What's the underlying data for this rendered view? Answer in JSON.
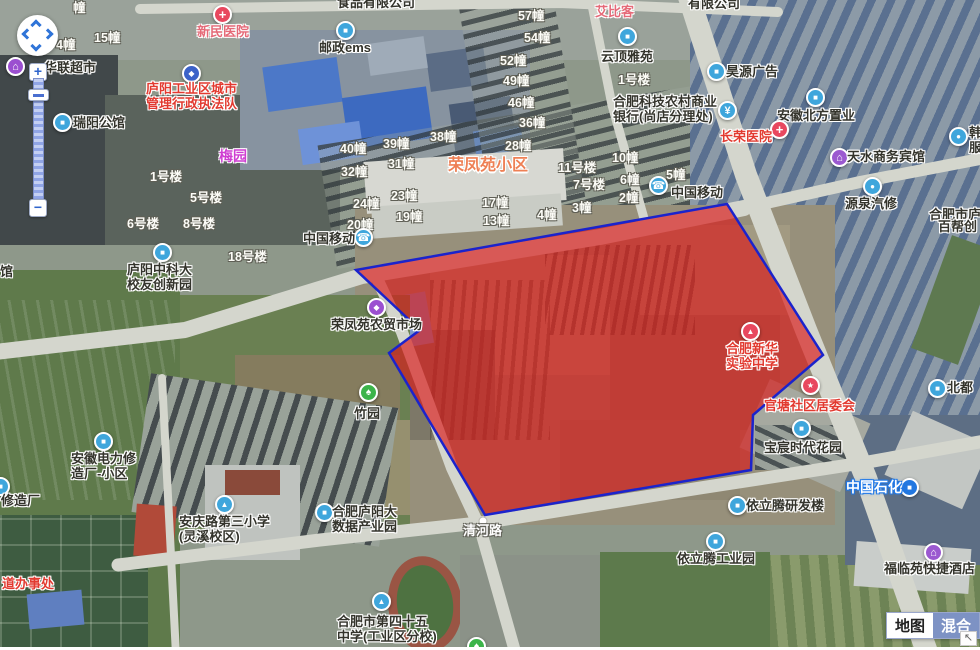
{
  "controls": {
    "zoom_in": "+",
    "zoom_out": "−",
    "corner_arrow": "↖",
    "map_type": [
      {
        "label": "地图",
        "active": false
      },
      {
        "label": "混合",
        "active": true
      }
    ]
  },
  "road_label": {
    "text": "清河路",
    "x": 463,
    "y": 524,
    "dot_x": 483,
    "dot_y": 521
  },
  "polygon": {
    "points": [
      [
        356,
        270
      ],
      [
        727,
        204
      ],
      [
        823,
        355
      ],
      [
        753,
        415
      ],
      [
        751,
        470
      ],
      [
        485,
        515
      ],
      [
        389,
        353
      ],
      [
        420,
        330
      ]
    ],
    "fill": "rgba(219,24,24,0.66)",
    "stroke": "#1b23cc",
    "stroke_width": 2.5
  },
  "area_labels": [
    {
      "t": "荣凤苑小区",
      "x": 448,
      "y": 157,
      "style": "orange",
      "size": 16
    },
    {
      "t": "艾比客",
      "x": 595,
      "y": 5,
      "style": "pink",
      "size": 13
    },
    {
      "t": "梅园",
      "x": 219,
      "y": 149,
      "style": "magenta",
      "size": 14
    }
  ],
  "building_labels": [
    {
      "t": "幢",
      "x": 73,
      "y": -3
    },
    {
      "t": "15幢",
      "x": 94,
      "y": 27
    },
    {
      "t": "4幢",
      "x": 56,
      "y": 34
    },
    {
      "t": "1号楼",
      "x": 150,
      "y": 166
    },
    {
      "t": "5号楼",
      "x": 190,
      "y": 187
    },
    {
      "t": "6号楼",
      "x": 127,
      "y": 213
    },
    {
      "t": "8号楼",
      "x": 183,
      "y": 213
    },
    {
      "t": "18号楼",
      "x": 228,
      "y": 246
    },
    {
      "t": "40幢",
      "x": 340,
      "y": 138
    },
    {
      "t": "39幢",
      "x": 383,
      "y": 133
    },
    {
      "t": "38幢",
      "x": 430,
      "y": 126
    },
    {
      "t": "32幢",
      "x": 341,
      "y": 161
    },
    {
      "t": "31幢",
      "x": 388,
      "y": 153
    },
    {
      "t": "24幢",
      "x": 353,
      "y": 193
    },
    {
      "t": "23幢",
      "x": 391,
      "y": 185
    },
    {
      "t": "19幢",
      "x": 396,
      "y": 206
    },
    {
      "t": "20幢",
      "x": 347,
      "y": 214
    },
    {
      "t": "17幢",
      "x": 482,
      "y": 192
    },
    {
      "t": "13幢",
      "x": 483,
      "y": 210
    },
    {
      "t": "57幢",
      "x": 518,
      "y": 5
    },
    {
      "t": "54幢",
      "x": 524,
      "y": 27
    },
    {
      "t": "52幢",
      "x": 500,
      "y": 50
    },
    {
      "t": "49幢",
      "x": 503,
      "y": 70
    },
    {
      "t": "46幢",
      "x": 508,
      "y": 92
    },
    {
      "t": "36幢",
      "x": 519,
      "y": 112
    },
    {
      "t": "28幢",
      "x": 505,
      "y": 135
    },
    {
      "t": "1号楼",
      "x": 618,
      "y": 69
    },
    {
      "t": "11号楼",
      "x": 558,
      "y": 157
    },
    {
      "t": "7号楼",
      "x": 573,
      "y": 174
    },
    {
      "t": "10幢",
      "x": 612,
      "y": 147
    },
    {
      "t": "6幢",
      "x": 620,
      "y": 169
    },
    {
      "t": "5幢",
      "x": 666,
      "y": 164
    },
    {
      "t": "2幢",
      "x": 619,
      "y": 187
    },
    {
      "t": "3幢",
      "x": 572,
      "y": 197
    },
    {
      "t": "4幢",
      "x": 537,
      "y": 204
    }
  ],
  "pois": [
    {
      "name": "xinmin-hospital",
      "icon": {
        "x": 222,
        "y": 14,
        "c": "#e8485f",
        "g": "+"
      },
      "label": {
        "x": 197,
        "y": 25,
        "lines": [
          "新民医院"
        ],
        "style": "pink"
      }
    },
    {
      "name": "chengguan-bureau",
      "icon": {
        "x": 191,
        "y": 73,
        "c": "#3b62c8",
        "g": "◆"
      },
      "label": {
        "x": 146,
        "y": 82,
        "lines": [
          "庐阳工业区城市",
          "管理行政执法队"
        ],
        "style": "red"
      }
    },
    {
      "name": "hualian-supermarket",
      "icon": {
        "x": 15,
        "y": 66,
        "c": "#9b4fd0",
        "g": "⌂"
      },
      "label": {
        "x": 44,
        "y": 61,
        "lines": [
          "华联超市"
        ],
        "style": "dark"
      }
    },
    {
      "name": "ruiyang-mansion",
      "icon": {
        "x": 62,
        "y": 122,
        "c": "#3fa6dc",
        "g": "■"
      },
      "label": {
        "x": 73,
        "y": 116,
        "lines": [
          "瑞阳公馆"
        ],
        "style": "dark"
      }
    },
    {
      "name": "ems-post",
      "icon": {
        "x": 345,
        "y": 30,
        "c": "#3fa6dc",
        "g": "■"
      },
      "label": {
        "x": 319,
        "y": 41,
        "lines": [
          "邮政ems"
        ],
        "style": "dark"
      }
    },
    {
      "name": "yunding-yayuan",
      "icon": {
        "x": 627,
        "y": 36,
        "c": "#3fa6dc",
        "g": "■"
      },
      "label": {
        "x": 601,
        "y": 50,
        "lines": [
          "云顶雅苑"
        ],
        "style": "dark"
      }
    },
    {
      "name": "rural-commercial-bank",
      "icon": {
        "x": 727,
        "y": 110,
        "c": "#3fa6dc",
        "g": "¥"
      },
      "label": {
        "x": 613,
        "y": 95,
        "lines": [
          "合肥科技农村商业",
          "银行(尚店分理处)"
        ],
        "style": "dark"
      }
    },
    {
      "name": "haoyuan-ad",
      "icon": {
        "x": 716,
        "y": 71,
        "c": "#3fa6dc",
        "g": "■"
      },
      "label": {
        "x": 726,
        "y": 65,
        "lines": [
          "昊源广告"
        ],
        "style": "dark"
      }
    },
    {
      "name": "anhui-beifang-realty",
      "icon": {
        "x": 815,
        "y": 97,
        "c": "#3fa6dc",
        "g": "■"
      },
      "label": {
        "x": 777,
        "y": 109,
        "lines": [
          "安徽北方置业"
        ],
        "style": "dark"
      }
    },
    {
      "name": "changrong-hospital",
      "icon": {
        "x": 779,
        "y": 129,
        "c": "#e8485f",
        "g": "+"
      },
      "label": {
        "x": 720,
        "y": 130,
        "lines": [
          "长荣医院"
        ],
        "style": "red"
      }
    },
    {
      "name": "tianshui-hotel",
      "icon": {
        "x": 839,
        "y": 157,
        "c": "#9b59d0",
        "g": "⌂"
      },
      "label": {
        "x": 847,
        "y": 150,
        "lines": [
          "天水商务宾馆"
        ],
        "style": "dark"
      }
    },
    {
      "name": "yuanquan-auto-repair",
      "icon": {
        "x": 872,
        "y": 186,
        "c": "#3fa6dc",
        "g": "●"
      },
      "label": {
        "x": 845,
        "y": 197,
        "lines": [
          "源泉汽修"
        ],
        "style": "dark"
      }
    },
    {
      "name": "edge-auto-poi",
      "icon": {
        "x": 958,
        "y": 136,
        "c": "#3fa6dc",
        "g": "●"
      },
      "label": {
        "x": 969,
        "y": 126,
        "lines": [
          "韩",
          "服"
        ],
        "style": "dark"
      }
    },
    {
      "name": "china-mobile-west",
      "icon": {
        "x": 363,
        "y": 237,
        "c": "#3fa6dc",
        "g": "☎"
      },
      "label": {
        "x": 303,
        "y": 232,
        "lines": [
          "中国移动"
        ],
        "style": "dark"
      }
    },
    {
      "name": "china-mobile-east",
      "icon": {
        "x": 658,
        "y": 185,
        "c": "#3fa6dc",
        "g": "☎"
      },
      "label": {
        "x": 671,
        "y": 186,
        "lines": [
          "中国移动"
        ],
        "style": "dark"
      }
    },
    {
      "name": "rongfengyuan-market",
      "icon": {
        "x": 376,
        "y": 307,
        "c": "#9b4fd0",
        "g": "◆"
      },
      "label": {
        "x": 331,
        "y": 318,
        "lines": [
          "荣凤苑农贸市场"
        ],
        "style": "dark"
      }
    },
    {
      "name": "zhuyuan-park",
      "icon": {
        "x": 368,
        "y": 392,
        "c": "#3cb44a",
        "g": "♠"
      },
      "label": {
        "x": 354,
        "y": 407,
        "lines": [
          "竹园"
        ],
        "style": "dark"
      }
    },
    {
      "name": "ustc-alumni-park",
      "icon": {
        "x": 162,
        "y": 252,
        "c": "#3fa6dc",
        "g": "■"
      },
      "label": {
        "x": 127,
        "y": 263,
        "lines": [
          "庐阳中科大",
          "校友创新园"
        ],
        "style": "dark"
      }
    },
    {
      "name": "anhui-electric-estate",
      "icon": {
        "x": 103,
        "y": 441,
        "c": "#3fa6dc",
        "g": "■"
      },
      "label": {
        "x": 71,
        "y": 452,
        "lines": [
          "安徽电力修",
          "造厂-小区"
        ],
        "style": "dark"
      }
    },
    {
      "name": "anqinglu-no3-school",
      "icon": {
        "x": 224,
        "y": 504,
        "c": "#3fa6dc",
        "g": "▲"
      },
      "label": {
        "x": 179,
        "y": 515,
        "lines": [
          "安庆路第三小学",
          "(灵溪校区)"
        ],
        "style": "dark"
      }
    },
    {
      "name": "bigdata-park",
      "icon": {
        "x": 324,
        "y": 512,
        "c": "#3fa6dc",
        "g": "■"
      },
      "label": {
        "x": 332,
        "y": 505,
        "lines": [
          "合肥庐阳大",
          "数据产业园"
        ],
        "style": "dark"
      }
    },
    {
      "name": "no45-middle-school",
      "icon": {
        "x": 381,
        "y": 601,
        "c": "#3fa6dc",
        "g": "▲"
      },
      "label": {
        "x": 337,
        "y": 615,
        "lines": [
          "合肥市第四十五",
          "中学(工业区分校)"
        ],
        "style": "dark"
      }
    },
    {
      "name": "xinhua-experimental-school",
      "icon": {
        "x": 750,
        "y": 331,
        "c": "#e8485f",
        "g": "▲"
      },
      "label": {
        "x": 726,
        "y": 342,
        "lines": [
          "合肥新华",
          "实验中学"
        ],
        "style": "red"
      }
    },
    {
      "name": "guantang-committee",
      "icon": {
        "x": 810,
        "y": 385,
        "c": "#e8485f",
        "g": "★"
      },
      "label": {
        "x": 764,
        "y": 399,
        "lines": [
          "官塘社区居委会"
        ],
        "style": "red"
      }
    },
    {
      "name": "baochen-times-garden",
      "icon": {
        "x": 801,
        "y": 428,
        "c": "#3fa6dc",
        "g": "■"
      },
      "label": {
        "x": 764,
        "y": 441,
        "lines": [
          "宝宸时代花园"
        ],
        "style": "dark"
      }
    },
    {
      "name": "sinopec-station",
      "icon": {
        "x": 909,
        "y": 487,
        "c": "#2277e0",
        "g": "■"
      },
      "label": {
        "x": 846,
        "y": 480,
        "lines": [
          "中国石化"
        ],
        "style": "bluehalo",
        "size": 14
      }
    },
    {
      "name": "yiliteng-rd-building",
      "icon": {
        "x": 737,
        "y": 505,
        "c": "#3fa6dc",
        "g": "■"
      },
      "label": {
        "x": 746,
        "y": 499,
        "lines": [
          "依立腾研发楼"
        ],
        "style": "dark"
      }
    },
    {
      "name": "yiliteng-industrial-park",
      "icon": {
        "x": 715,
        "y": 541,
        "c": "#3fa6dc",
        "g": "■"
      },
      "label": {
        "x": 677,
        "y": 552,
        "lines": [
          "依立腾工业园"
        ],
        "style": "dark"
      }
    },
    {
      "name": "fulinyuan-express-hotel",
      "icon": {
        "x": 933,
        "y": 552,
        "c": "#9b59d0",
        "g": "⌂"
      },
      "label": {
        "x": 884,
        "y": 562,
        "lines": [
          "福临苑快捷酒店"
        ],
        "style": "dark"
      }
    },
    {
      "name": "beidu-poi",
      "icon": {
        "x": 937,
        "y": 388,
        "c": "#3fa6dc",
        "g": "■"
      },
      "label": {
        "x": 947,
        "y": 381,
        "lines": [
          "北都"
        ],
        "style": "dark"
      }
    },
    {
      "name": "bubang-partial-1",
      "label": {
        "x": 929,
        "y": 208,
        "lines": [
          "合肥市庐"
        ],
        "style": "dark"
      }
    },
    {
      "name": "bubang-partial-2",
      "label": {
        "x": 938,
        "y": 220,
        "lines": [
          "百帮创"
        ],
        "style": "dark"
      }
    },
    {
      "name": "green-poi-partial",
      "icon": {
        "x": 476,
        "y": 646,
        "c": "#3cb44a",
        "g": "♠"
      }
    },
    {
      "name": "blue-poi-partial",
      "icon": {
        "x": 0,
        "y": 486,
        "c": "#3fa6dc",
        "g": "■"
      }
    },
    {
      "name": "xiuzaochang-partial",
      "label": {
        "x": 1,
        "y": 494,
        "lines": [
          "修造厂"
        ],
        "style": "dark"
      }
    },
    {
      "name": "jiedao-office-partial",
      "label": {
        "x": 2,
        "y": 577,
        "lines": [
          "道办事处"
        ],
        "style": "red"
      }
    },
    {
      "name": "guan-partial",
      "label": {
        "x": 0,
        "y": 265,
        "lines": [
          "馆"
        ],
        "style": "dark"
      }
    },
    {
      "name": "shipin-company-partial",
      "label": {
        "x": 337,
        "y": -4,
        "lines": [
          "食品有限公司"
        ],
        "style": "dark"
      }
    },
    {
      "name": "company-partial-top",
      "label": {
        "x": 688,
        "y": -3,
        "lines": [
          "有限公司"
        ],
        "style": "dark"
      }
    }
  ]
}
